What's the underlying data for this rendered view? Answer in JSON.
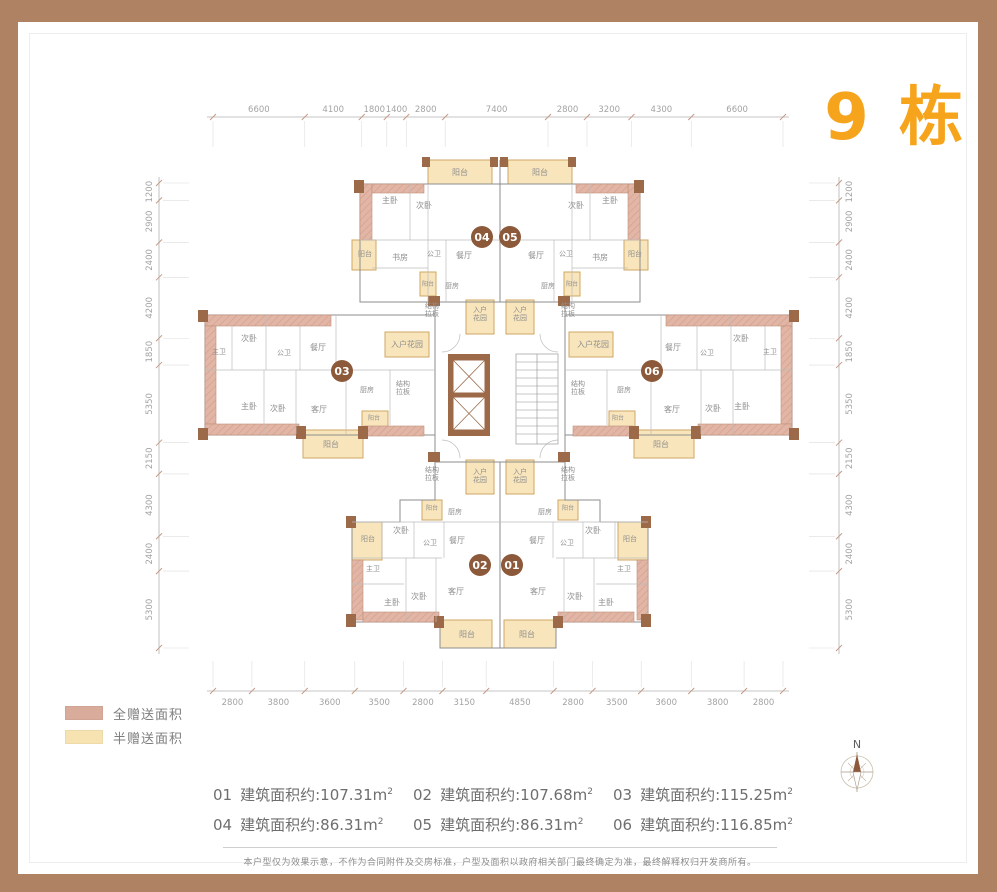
{
  "title": "9 栋",
  "legend": {
    "items": [
      {
        "label": "全赠送面积",
        "color": "#d9ab9b"
      },
      {
        "label": "半赠送面积",
        "color": "#f7e3b1"
      }
    ]
  },
  "areas": {
    "items": [
      {
        "no": "01",
        "text": "建筑面积约:107.31m",
        "sup": "2"
      },
      {
        "no": "02",
        "text": "建筑面积约:107.68m",
        "sup": "2"
      },
      {
        "no": "03",
        "text": "建筑面积约:115.25m",
        "sup": "2"
      },
      {
        "no": "04",
        "text": "建筑面积约:86.31m",
        "sup": "2"
      },
      {
        "no": "05",
        "text": "建筑面积约:86.31m",
        "sup": "2"
      },
      {
        "no": "06",
        "text": "建筑面积约:116.85m",
        "sup": "2"
      }
    ]
  },
  "dimensions": {
    "top": [
      "6600",
      "4100",
      "1800",
      "1400",
      "2800",
      "7400",
      "2800",
      "3200",
      "4300",
      "6600"
    ],
    "bottom": [
      "2800",
      "3800",
      "3600",
      "3500",
      "2800",
      "3150",
      "4850",
      "2800",
      "3500",
      "3600",
      "3800",
      "2800"
    ],
    "left": [
      "1200",
      "2900",
      "2400",
      "4200",
      "1850",
      "5350",
      "2150",
      "4300",
      "2400",
      "5300"
    ],
    "right": [
      "1200",
      "2900",
      "2400",
      "4200",
      "1850",
      "5350",
      "2150",
      "4300",
      "2400",
      "5300"
    ]
  },
  "compass": {
    "label": "N"
  },
  "disclaimer": "本户型仅为效果示意，不作为合同附件及交房标准，户型及面积以政府相关部门最终确定为准，最终解释权归开发商所有。",
  "colors": {
    "frame": "#b08264",
    "title": "#f7a41d",
    "badge": "#8c5a3a",
    "wall_pink": "#e2b6a6",
    "balcony_yellow": "#f8e5bb"
  },
  "plan": {
    "units": [
      {
        "no": "01",
        "x": 512,
        "y": 565
      },
      {
        "no": "02",
        "x": 480,
        "y": 565
      },
      {
        "no": "03",
        "x": 342,
        "y": 371
      },
      {
        "no": "04",
        "x": 482,
        "y": 237
      },
      {
        "no": "05",
        "x": 510,
        "y": 237
      },
      {
        "no": "06",
        "x": 652,
        "y": 371
      }
    ],
    "rooms": [
      {
        "t": "阳台",
        "x": 460,
        "y": 175
      },
      {
        "t": "阳台",
        "x": 540,
        "y": 175
      },
      {
        "t": "主卧",
        "x": 390,
        "y": 203
      },
      {
        "t": "次卧",
        "x": 424,
        "y": 208
      },
      {
        "t": "次卧",
        "x": 576,
        "y": 208
      },
      {
        "t": "主卧",
        "x": 610,
        "y": 203
      },
      {
        "t": "阳台",
        "x": 365,
        "y": 256,
        "fs": 7
      },
      {
        "t": "书房",
        "x": 400,
        "y": 260
      },
      {
        "t": "公卫",
        "x": 434,
        "y": 256,
        "fs": 7
      },
      {
        "t": "餐厅",
        "x": 464,
        "y": 258
      },
      {
        "t": "餐厅",
        "x": 536,
        "y": 258
      },
      {
        "t": "公卫",
        "x": 566,
        "y": 256,
        "fs": 7
      },
      {
        "t": "书房",
        "x": 600,
        "y": 260
      },
      {
        "t": "阳台",
        "x": 635,
        "y": 256,
        "fs": 7
      },
      {
        "t": "厨房",
        "x": 452,
        "y": 288,
        "fs": 7
      },
      {
        "t": "阳台",
        "x": 428,
        "y": 286,
        "fs": 6
      },
      {
        "t": "阳台",
        "x": 572,
        "y": 286,
        "fs": 6
      },
      {
        "t": "厨房",
        "x": 548,
        "y": 288,
        "fs": 7
      },
      {
        "lines": [
          "结构",
          "拉板"
        ],
        "x": 432,
        "y": 308,
        "fs": 7
      },
      {
        "lines": [
          "入户",
          "花园"
        ],
        "x": 480,
        "y": 312,
        "fs": 7
      },
      {
        "lines": [
          "入户",
          "花园"
        ],
        "x": 520,
        "y": 312,
        "fs": 7
      },
      {
        "lines": [
          "结构",
          "拉板"
        ],
        "x": 568,
        "y": 308,
        "fs": 7
      },
      {
        "t": "入户花园",
        "x": 407,
        "y": 347
      },
      {
        "t": "入户花园",
        "x": 593,
        "y": 347
      },
      {
        "lines": [
          "结构",
          "拉板"
        ],
        "x": 403,
        "y": 386,
        "fs": 7
      },
      {
        "lines": [
          "结构",
          "拉板"
        ],
        "x": 578,
        "y": 386,
        "fs": 7
      },
      {
        "t": "主卫",
        "x": 219,
        "y": 354,
        "fs": 7
      },
      {
        "t": "次卧",
        "x": 249,
        "y": 341
      },
      {
        "t": "公卫",
        "x": 284,
        "y": 355,
        "fs": 7
      },
      {
        "t": "餐厅",
        "x": 318,
        "y": 350
      },
      {
        "t": "主卧",
        "x": 249,
        "y": 409
      },
      {
        "t": "次卧",
        "x": 278,
        "y": 411
      },
      {
        "t": "客厅",
        "x": 319,
        "y": 412
      },
      {
        "t": "厨房",
        "x": 367,
        "y": 392,
        "fs": 7
      },
      {
        "t": "阳台",
        "x": 374,
        "y": 420,
        "fs": 6
      },
      {
        "t": "阳台",
        "x": 331,
        "y": 447
      },
      {
        "t": "餐厅",
        "x": 673,
        "y": 350
      },
      {
        "t": "公卫",
        "x": 707,
        "y": 355,
        "fs": 7
      },
      {
        "t": "次卧",
        "x": 741,
        "y": 341
      },
      {
        "t": "主卫",
        "x": 770,
        "y": 354,
        "fs": 7
      },
      {
        "t": "厨房",
        "x": 624,
        "y": 392,
        "fs": 7
      },
      {
        "t": "客厅",
        "x": 672,
        "y": 412
      },
      {
        "t": "次卧",
        "x": 713,
        "y": 411
      },
      {
        "t": "主卧",
        "x": 742,
        "y": 409
      },
      {
        "t": "阳台",
        "x": 618,
        "y": 420,
        "fs": 6
      },
      {
        "t": "阳台",
        "x": 661,
        "y": 447
      },
      {
        "lines": [
          "结构",
          "拉板"
        ],
        "x": 432,
        "y": 472,
        "fs": 7
      },
      {
        "lines": [
          "入户",
          "花园"
        ],
        "x": 480,
        "y": 474,
        "fs": 7
      },
      {
        "lines": [
          "入户",
          "花园"
        ],
        "x": 520,
        "y": 474,
        "fs": 7
      },
      {
        "lines": [
          "结构",
          "拉板"
        ],
        "x": 568,
        "y": 472,
        "fs": 7
      },
      {
        "t": "阳台",
        "x": 432,
        "y": 510,
        "fs": 6
      },
      {
        "t": "厨房",
        "x": 455,
        "y": 514,
        "fs": 7
      },
      {
        "t": "厨房",
        "x": 545,
        "y": 514,
        "fs": 7
      },
      {
        "t": "阳台",
        "x": 568,
        "y": 510,
        "fs": 6
      },
      {
        "t": "阳台",
        "x": 368,
        "y": 541,
        "fs": 7
      },
      {
        "t": "次卧",
        "x": 401,
        "y": 533
      },
      {
        "t": "公卫",
        "x": 430,
        "y": 545,
        "fs": 7
      },
      {
        "t": "餐厅",
        "x": 457,
        "y": 543
      },
      {
        "t": "餐厅",
        "x": 537,
        "y": 543
      },
      {
        "t": "公卫",
        "x": 567,
        "y": 545,
        "fs": 7
      },
      {
        "t": "次卧",
        "x": 593,
        "y": 533
      },
      {
        "t": "阳台",
        "x": 630,
        "y": 541,
        "fs": 7
      },
      {
        "t": "主卫",
        "x": 373,
        "y": 571,
        "fs": 7
      },
      {
        "t": "主卫",
        "x": 624,
        "y": 571,
        "fs": 7
      },
      {
        "t": "主卧",
        "x": 392,
        "y": 605
      },
      {
        "t": "次卧",
        "x": 419,
        "y": 599
      },
      {
        "t": "客厅",
        "x": 456,
        "y": 594
      },
      {
        "t": "客厅",
        "x": 538,
        "y": 594
      },
      {
        "t": "次卧",
        "x": 575,
        "y": 599
      },
      {
        "t": "主卧",
        "x": 606,
        "y": 605
      },
      {
        "t": "阳台",
        "x": 467,
        "y": 637
      },
      {
        "t": "阳台",
        "x": 527,
        "y": 637
      }
    ]
  }
}
